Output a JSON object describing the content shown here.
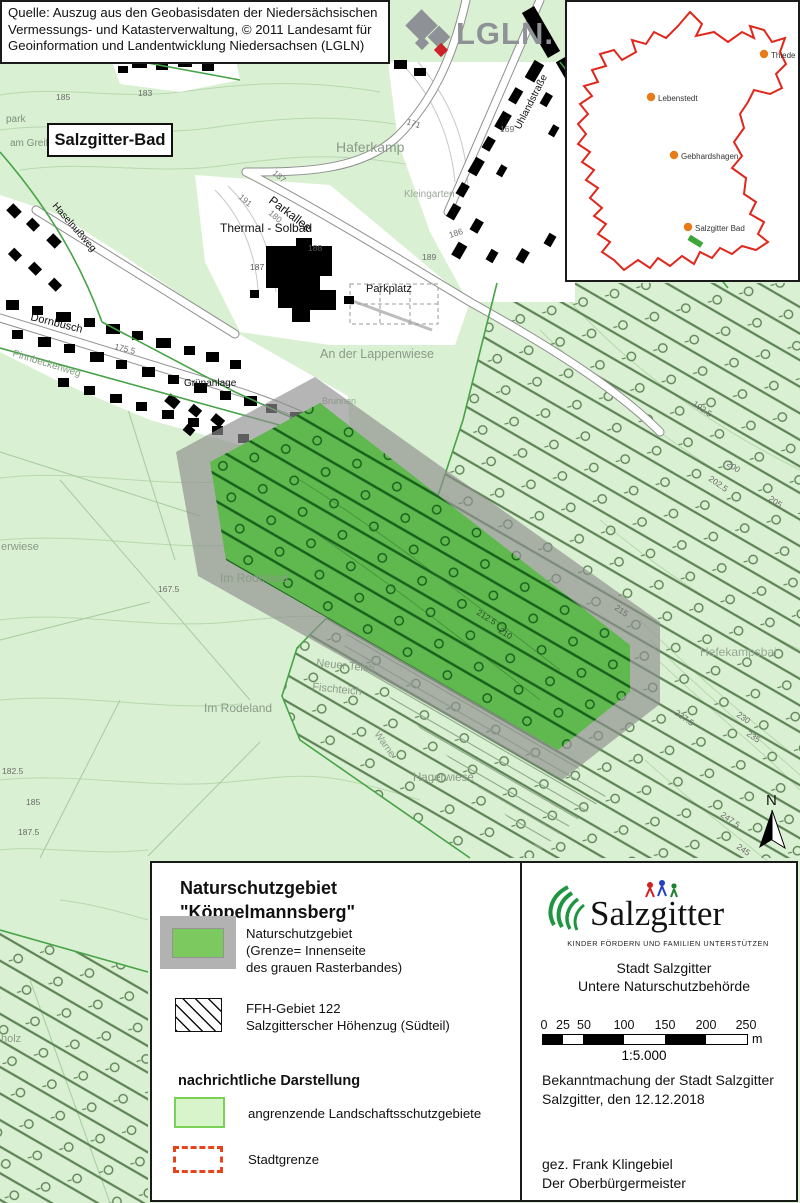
{
  "source_box": {
    "line1": "Quelle: Auszug aus den Geobasisdaten der Niedersächsischen",
    "line2": "Vermessungs- und Katasterverwaltung, © 2011 Landesamt für",
    "line3": "Geoinformation und Landentwicklung Niedersachsen (LGLN)"
  },
  "lgln": {
    "wordmark": "LGLN."
  },
  "inset": {
    "boundary_color": "#e0271c",
    "dot_color": "#e87b18",
    "nsg_marker_color": "#3da639",
    "places": [
      {
        "label": "Thiede"
      },
      {
        "label": "Lebenstedt"
      },
      {
        "label": "Gebhardshagen"
      },
      {
        "label": "Salzgitter Bad"
      }
    ]
  },
  "map": {
    "city_label": "Salzgitter-Bad",
    "labels": {
      "park": "park",
      "am_greif": "am Greif",
      "haferkamp": "Haferkamp",
      "kleingarten": "Kleingarten",
      "uhlandstrasse": "Uhlandstraße",
      "parkallee": "Parkallee",
      "thermal_solbad": "Thermal - Solbad",
      "parkplatz": "Parkplatz",
      "dornbusch": "Dornbusch",
      "haselnussweg": "Haselnußweg",
      "pinnbeckenweg": "Pinnbeckenweg",
      "gruenanlage": "Grünanlage",
      "lappenwiese": "An der Lappenwiese",
      "brunnen": "Brunnen",
      "im_rodeland_a": "Im Rodeland",
      "im_rodeland_b": "Im Rodeland",
      "erwiese": "erwiese",
      "neuer_teich": "Neuer Teich",
      "fischteich": "Fischteich",
      "warne": "Warne",
      "hagerwiese": "Hagerwiese",
      "hefekampsbai": "Hefekampsbai",
      "holz": "holz"
    },
    "elevations": [
      "183",
      "185",
      "171",
      "169",
      "187",
      "180",
      "191",
      "188",
      "187",
      "189",
      "186",
      "167.5",
      "175.5",
      "182.5",
      "185",
      "187.5",
      "192.5",
      "200",
      "202.5",
      "205",
      "210",
      "212.5",
      "215",
      "237.5",
      "230",
      "235",
      "247.5",
      "245"
    ],
    "north_label": "N"
  },
  "legend": {
    "title_line1": "Naturschutzgebiet",
    "title_line2": "\"Köppelmannsberg\"",
    "nsg_item": {
      "line1": "Naturschutzgebiet",
      "line2": "(Grenze= Innenseite",
      "line3": "des grauen Rasterbandes)"
    },
    "ffh_item": {
      "line1": "FFH-Gebiet 122",
      "line2": "Salzgitterscher Höhenzug (Südteil)"
    },
    "heading_info": "nachrichtliche Darstellung",
    "lsg_item": "angrenzende Landschaftsschutzgebiete",
    "boundary_item": "Stadtgrenze"
  },
  "panel": {
    "logo_text": "Salzgitter",
    "logo_tagline": "KINDER FÖRDERN UND FAMILIEN UNTERSTÜTZEN",
    "authority_line1": "Stadt Salzgitter",
    "authority_line2": "Untere Naturschutzbehörde",
    "scalebar": {
      "ticks": [
        "0",
        "25",
        "50",
        "100",
        "150",
        "200",
        "250"
      ],
      "unit": "m",
      "ratio": "1:5.000"
    },
    "announcement_line1": "Bekanntmachung der Stadt Salzgitter",
    "announcement_line2": "Salzgitter, den 12.12.2018",
    "signature_line1": "gez. Frank Klingebiel",
    "signature_line2": "Der Oberbürgermeister"
  },
  "colors": {
    "lsg_green": "#daf0d2",
    "nsg_green": "#60b94e",
    "band_gray": "#8f8f8f",
    "ffh_hatch": "#5d8356",
    "stadtgrenze_red": "#e8441c"
  }
}
